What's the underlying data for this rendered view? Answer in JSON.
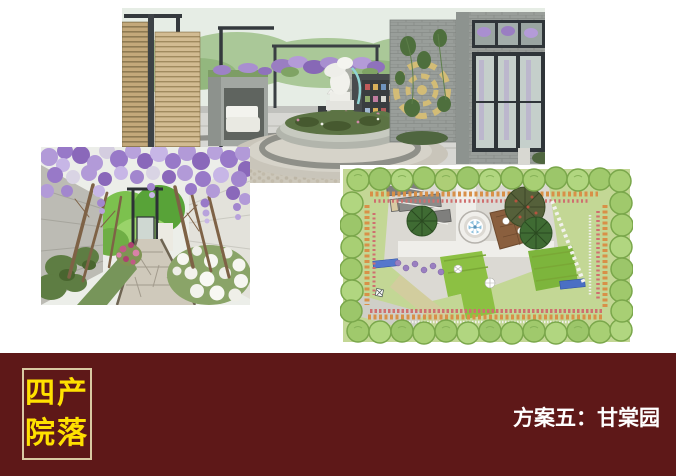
{
  "banner": {
    "background_color": "#5E1818",
    "box_border_color": "#D9C9A2",
    "box_text_color": "#FFE100",
    "box_line1": "四产",
    "box_line2": "院落",
    "title": "方案五：甘棠园",
    "title_color": "#FFFFFF"
  },
  "figures": {
    "courtyard_render": "courtyard-fountain-perspective-render",
    "alley_render": "wisteria-alley-perspective-render",
    "master_plan": "garden-master-plan-top-view"
  }
}
